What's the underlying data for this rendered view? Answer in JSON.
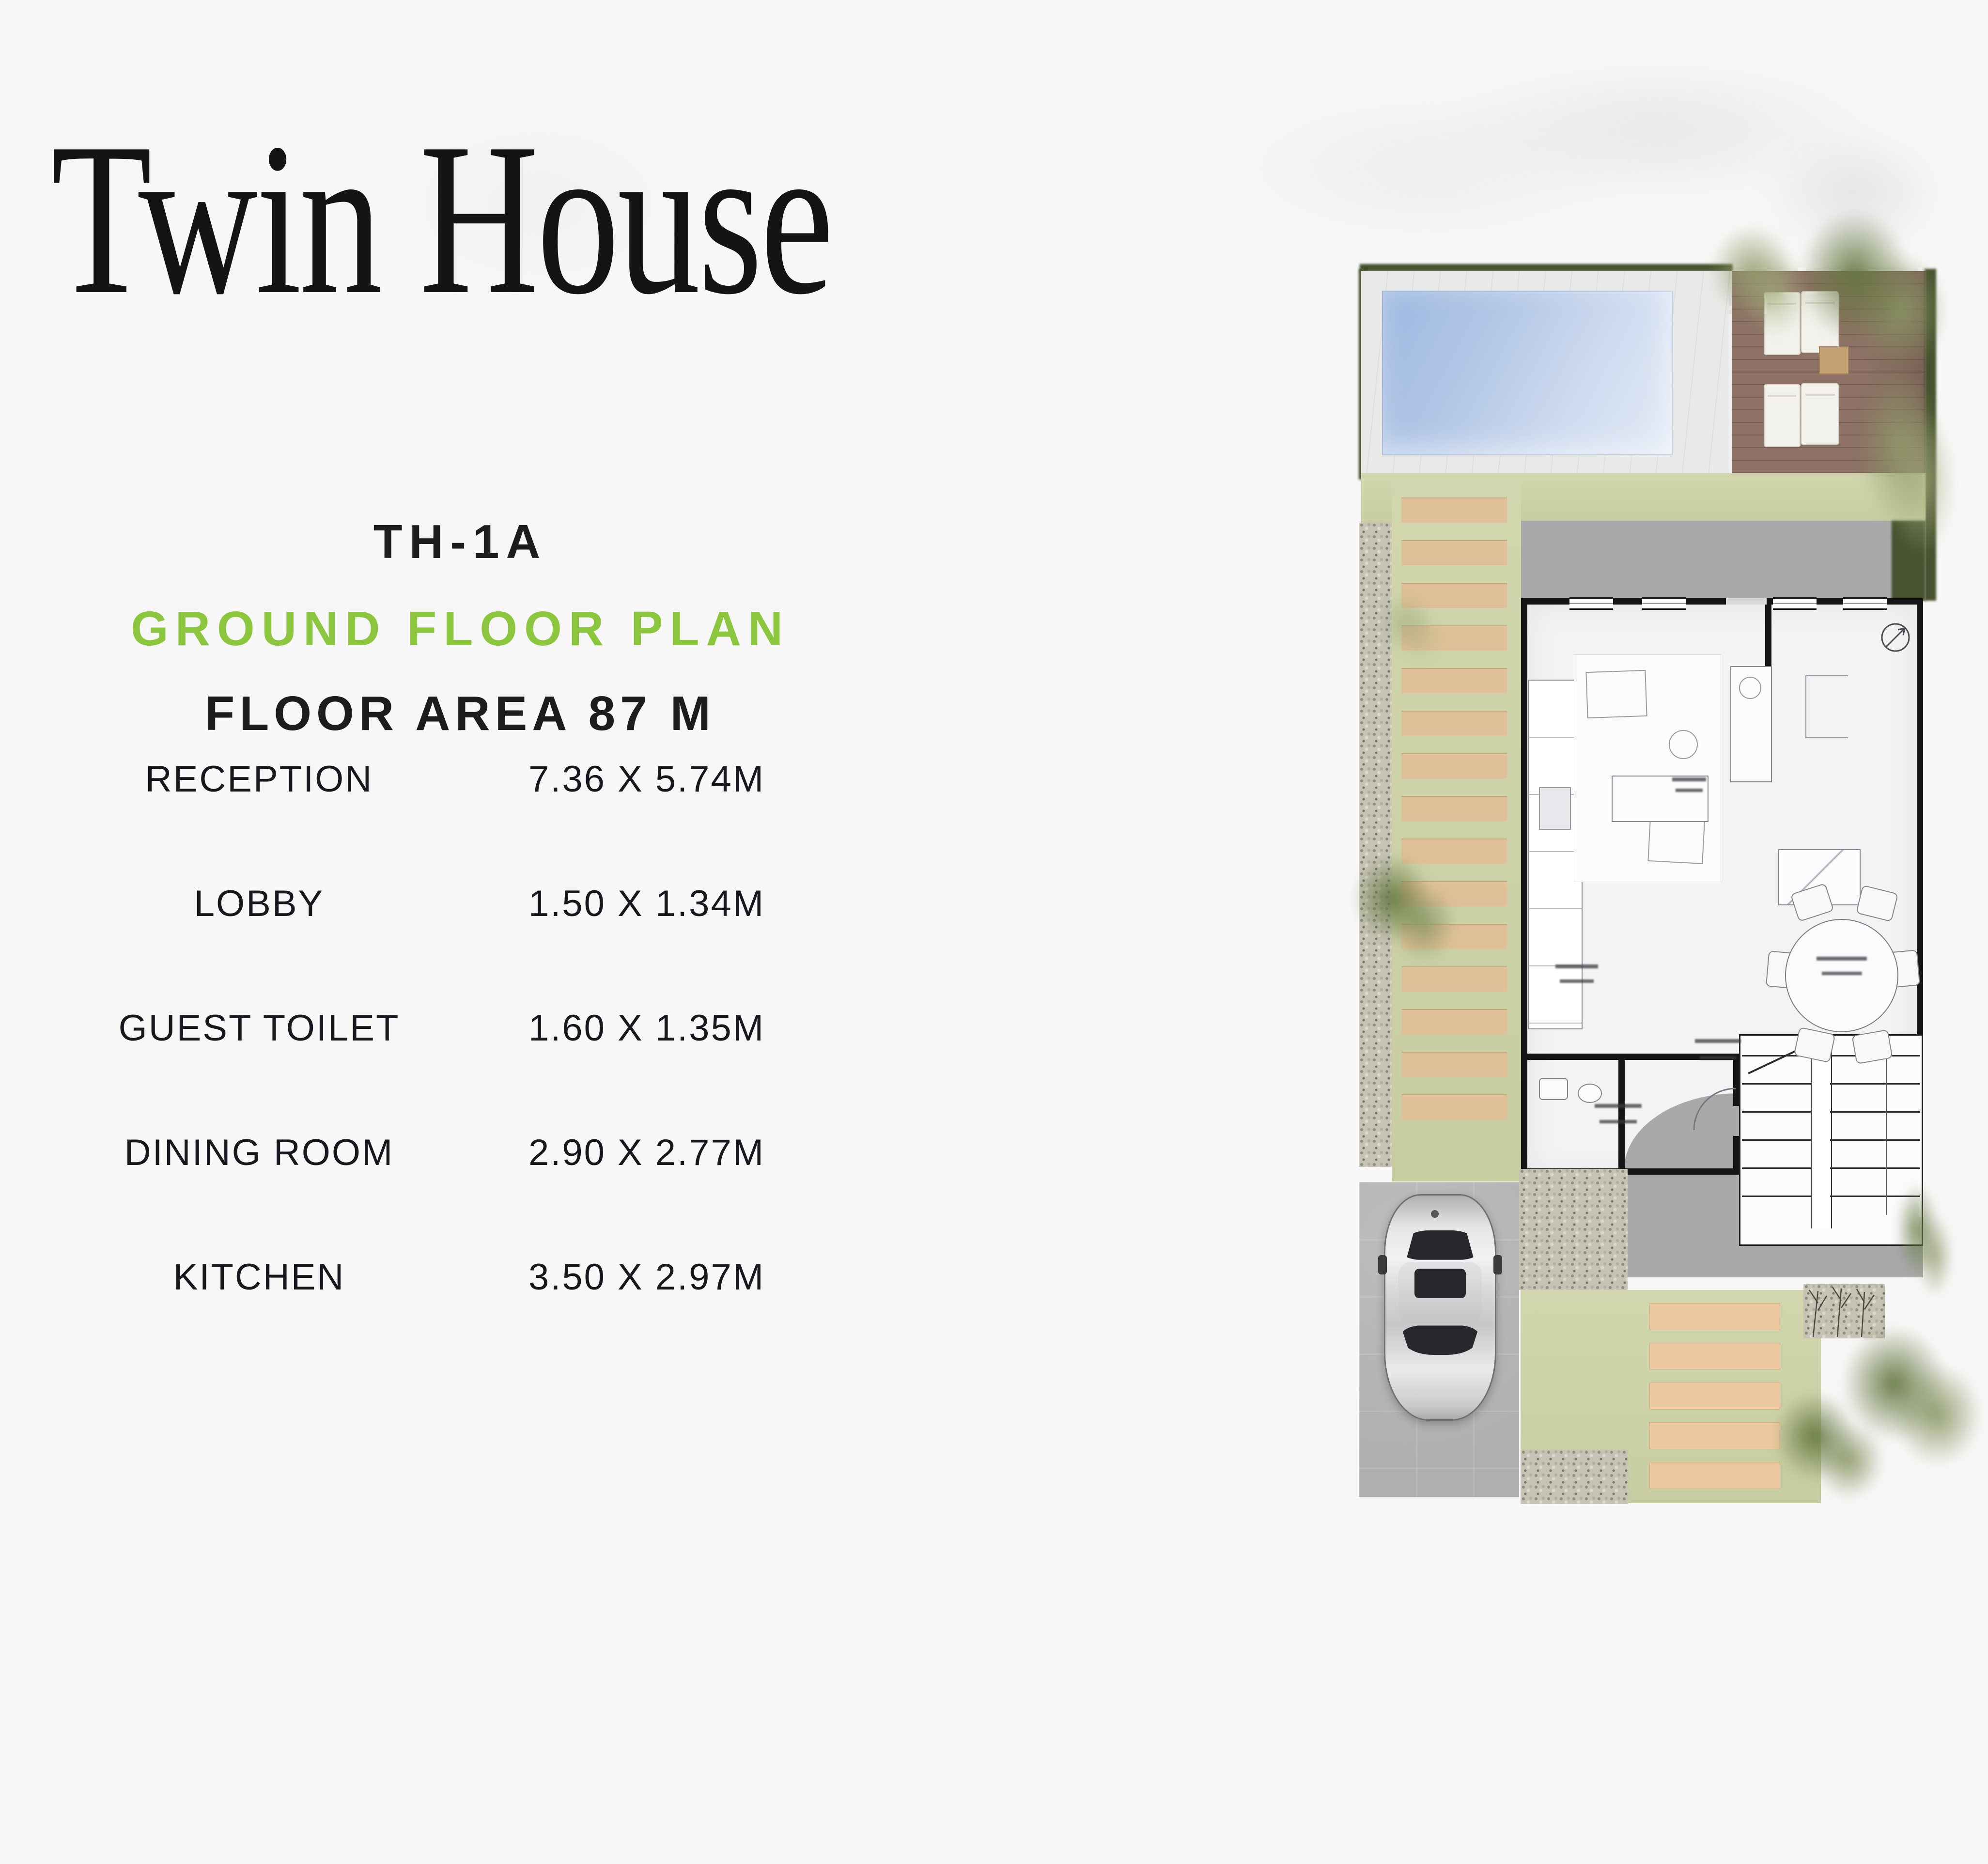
{
  "page": {
    "title": "Twin House"
  },
  "plan_info": {
    "unit_code": "TH-1A",
    "plan_name": "GROUND FLOOR PLAN",
    "floor_area": "FLOOR AREA 87 M"
  },
  "rooms": [
    {
      "label": "RECEPTION",
      "dimensions": "7.36 X 5.74M"
    },
    {
      "label": "LOBBY",
      "dimensions": "1.50 X 1.34M"
    },
    {
      "label": "GUEST TOILET",
      "dimensions": "1.60 X 1.35M"
    },
    {
      "label": "DINING ROOM",
      "dimensions": "2.90 X 2.77M"
    },
    {
      "label": "KITCHEN",
      "dimensions": "3.50 X 2.97M"
    }
  ],
  "colors": {
    "accent_green": "#8CC63E",
    "text_dark": "#1C1D1F",
    "pool_blue": "#9CB8E0",
    "grass_green": "#CED3A7",
    "wood_deck_brown": "#8D7265",
    "plank_tan": "#DFC098",
    "paving_gray": "#B5B7B6",
    "patio_gray": "#A8A9AB",
    "wall_black": "#151515"
  }
}
